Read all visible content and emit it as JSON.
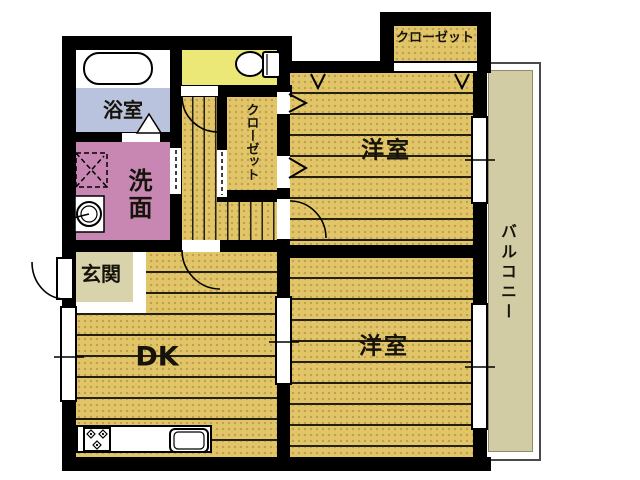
{
  "rooms": {
    "bathroom": {
      "label": "浴室",
      "color": "#b9c3de"
    },
    "washroom": {
      "label": "洗面",
      "color": "#c887b3"
    },
    "toilet": {
      "color": "#ece878"
    },
    "hall_closet": {
      "label": "クローゼット",
      "color": "#e2c568"
    },
    "top_closet": {
      "label": "クローゼット",
      "color": "#e2c568"
    },
    "bedroom_top": {
      "label": "洋室",
      "color": "#e2c568"
    },
    "bedroom_bottom": {
      "label": "洋室",
      "color": "#e2c568"
    },
    "dining_kitchen": {
      "label": "DK",
      "color": "#e2c568"
    },
    "entrance": {
      "label": "玄関",
      "color": "#d9d3ab"
    },
    "balcony": {
      "label": "バルコニー",
      "color": "#d2cca4"
    }
  },
  "palette": {
    "wall": "#000000",
    "wood": "#e2c568",
    "stripe": "#221f10",
    "background": "#ffffff",
    "balcony_border": "#4a4a4a"
  }
}
